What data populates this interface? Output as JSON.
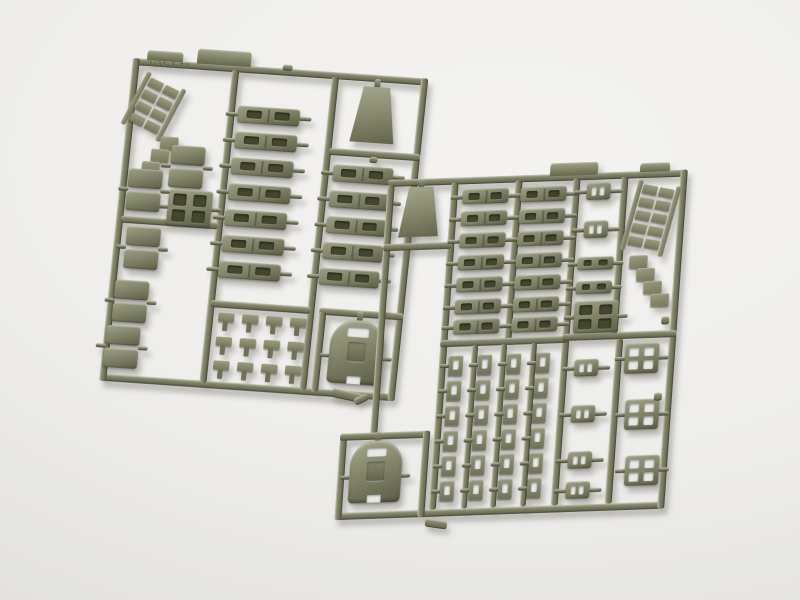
{
  "photo": {
    "embossed_text": "1/35 T-72",
    "colors": {
      "background": "#f4f3f1",
      "background_edge": "#d7d6d4",
      "plastic": "#7d7f64",
      "plastic_light": "#9da083",
      "plastic_dark": "#5b5d45",
      "slot": "#44462f",
      "hole": "#e9e8e4",
      "shadow": "rgba(108,106,94,0.42)"
    },
    "sprues": [
      {
        "id": "A",
        "name": "sprue-left",
        "origin": {
          "x": 133,
          "y": 58
        },
        "rotate": 4,
        "skew": -2,
        "width": 296,
        "height": 324,
        "rails": [
          [
            0,
            0,
            296,
            7
          ],
          [
            0,
            317,
            296,
            7
          ],
          [
            0,
            0,
            7,
            324
          ],
          [
            289,
            0,
            7,
            324
          ],
          [
            100,
            5,
            7,
            314
          ],
          [
            200,
            5,
            7,
            314
          ],
          [
            205,
            76,
            91,
            7
          ],
          [
            212,
            236,
            84,
            7
          ],
          [
            212,
            240,
            7,
            80
          ],
          [
            5,
            158,
            97,
            7
          ],
          [
            103,
            236,
            100,
            7
          ]
        ],
        "tabs": [
          [
            14,
            -9,
            36,
            10
          ],
          [
            64,
            -14,
            54,
            15
          ]
        ],
        "label_pos": {
          "x": 16,
          "y": 0.5,
          "w": 84
        },
        "parts": [
          {
            "t": "grid",
            "x": 16,
            "y": 12,
            "rows": 4,
            "rot": 22
          },
          {
            "t": "stair",
            "x": 36,
            "y": 76,
            "n": 3,
            "dx": -8,
            "dy": 13
          },
          {
            "t": "pair",
            "x": 48,
            "y": 84
          },
          {
            "t": "block4",
            "x": 50,
            "y": 128,
            "w": 44,
            "h": 36,
            "holes": false
          },
          {
            "t": "pair",
            "x": 8,
            "y": 110
          },
          {
            "t": "pair",
            "x": 12,
            "y": 168
          },
          {
            "t": "pair",
            "x": 6,
            "y": 222
          },
          {
            "t": "pair",
            "x": 2,
            "y": 268
          },
          {
            "t": "link",
            "x": 110,
            "y": 40,
            "w": 62,
            "h": 17
          },
          {
            "t": "link",
            "x": 110,
            "y": 66,
            "w": 62,
            "h": 17
          },
          {
            "t": "link",
            "x": 109,
            "y": 92,
            "w": 62,
            "h": 17
          },
          {
            "t": "link",
            "x": 109,
            "y": 118,
            "w": 62,
            "h": 17
          },
          {
            "t": "link",
            "x": 108,
            "y": 144,
            "w": 62,
            "h": 17
          },
          {
            "t": "link",
            "x": 108,
            "y": 170,
            "w": 62,
            "h": 17
          },
          {
            "t": "link",
            "x": 107,
            "y": 196,
            "w": 62,
            "h": 17
          },
          {
            "t": "trap",
            "x": 224,
            "y": 12,
            "w": 44,
            "h": 56
          },
          {
            "t": "link",
            "x": 211,
            "y": 92,
            "w": 60,
            "h": 17
          },
          {
            "t": "link",
            "x": 210,
            "y": 118,
            "w": 60,
            "h": 17
          },
          {
            "t": "link",
            "x": 210,
            "y": 144,
            "w": 60,
            "h": 17
          },
          {
            "t": "link",
            "x": 209,
            "y": 170,
            "w": 60,
            "h": 17
          },
          {
            "t": "link",
            "x": 208,
            "y": 196,
            "w": 60,
            "h": 17
          },
          {
            "t": "tgrid",
            "x": 112,
            "y": 248,
            "rows": 3,
            "cols": 4,
            "px": 24,
            "py": 24
          },
          {
            "t": "dome",
            "x": 226,
            "y": 246,
            "w": 54,
            "h": 64
          },
          {
            "t": "nub",
            "x": 150,
            "y": -4,
            "w": 10,
            "h": 6
          },
          {
            "t": "nub",
            "x": 246,
            "y": 82,
            "w": 8,
            "h": 6
          }
        ]
      },
      {
        "id": "B",
        "name": "sprue-right",
        "origin": {
          "x": 388,
          "y": 180
        },
        "rotate": -2,
        "skew": -6,
        "width": 300,
        "height": 338,
        "rails": [
          [
            0,
            0,
            300,
            7
          ],
          [
            -30,
            331,
            330,
            7
          ],
          [
            0,
            5,
            7,
            250
          ],
          [
            293,
            0,
            7,
            338
          ],
          [
            64,
            5,
            7,
            326
          ],
          [
            186,
            5,
            7,
            326
          ],
          [
            128,
            5,
            7,
            160
          ],
          [
            0,
            64,
            68,
            7
          ],
          [
            64,
            162,
            129,
            7
          ],
          [
            186,
            160,
            114,
            7
          ],
          [
            96,
            168,
            6,
            163
          ],
          [
            125,
            168,
            6,
            163
          ],
          [
            155,
            168,
            6,
            163
          ],
          [
            234,
            5,
            7,
            156
          ],
          [
            240,
            167,
            7,
            164
          ],
          [
            -30,
            252,
            7,
            86
          ],
          [
            -30,
            252,
            90,
            7
          ],
          [
            53,
            252,
            7,
            86
          ]
        ],
        "tabs": [
          [
            162,
            -11,
            48,
            13
          ],
          [
            252,
            -8,
            30,
            9
          ]
        ],
        "parts": [
          {
            "t": "trap",
            "x": 14,
            "y": 8,
            "w": 40,
            "h": 50
          },
          {
            "t": "link",
            "x": 76,
            "y": 12,
            "w": 46,
            "h": 15
          },
          {
            "t": "link",
            "x": 134,
            "y": 12,
            "w": 46,
            "h": 15
          },
          {
            "t": "link",
            "x": 76,
            "y": 34,
            "w": 46,
            "h": 15
          },
          {
            "t": "link",
            "x": 134,
            "y": 34,
            "w": 46,
            "h": 15
          },
          {
            "t": "link",
            "x": 76,
            "y": 56,
            "w": 46,
            "h": 15
          },
          {
            "t": "link",
            "x": 134,
            "y": 56,
            "w": 46,
            "h": 15
          },
          {
            "t": "link",
            "x": 76,
            "y": 78,
            "w": 46,
            "h": 15
          },
          {
            "t": "link",
            "x": 134,
            "y": 78,
            "w": 46,
            "h": 15
          },
          {
            "t": "link",
            "x": 76,
            "y": 100,
            "w": 46,
            "h": 15
          },
          {
            "t": "link",
            "x": 134,
            "y": 100,
            "w": 46,
            "h": 15
          },
          {
            "t": "link",
            "x": 76,
            "y": 122,
            "w": 46,
            "h": 15
          },
          {
            "t": "link",
            "x": 134,
            "y": 122,
            "w": 46,
            "h": 15
          },
          {
            "t": "link",
            "x": 76,
            "y": 142,
            "w": 46,
            "h": 15
          },
          {
            "t": "link",
            "x": 134,
            "y": 142,
            "w": 46,
            "h": 15
          },
          {
            "t": "padgrid",
            "x": 74,
            "y": 178,
            "rows": 6,
            "cols": 4,
            "px": 29,
            "py": 25
          },
          {
            "t": "pad2",
            "x": 200,
            "y": 10,
            "w": 24,
            "h": 17
          },
          {
            "t": "pad2",
            "x": 200,
            "y": 48,
            "w": 24,
            "h": 17
          },
          {
            "t": "bar2",
            "x": 196,
            "y": 84,
            "w": 36,
            "h": 13
          },
          {
            "t": "bar2",
            "x": 196,
            "y": 108,
            "w": 36,
            "h": 13
          },
          {
            "t": "block4",
            "x": 196,
            "y": 128,
            "w": 44,
            "h": 32,
            "holes": false
          },
          {
            "t": "grid",
            "x": 252,
            "y": 8,
            "rows": 5,
            "rot": 12
          },
          {
            "t": "stair",
            "x": 248,
            "y": 84,
            "n": 4,
            "dx": 8,
            "dy": 13
          },
          {
            "t": "pad2",
            "x": 200,
            "y": 186,
            "w": 24,
            "h": 17
          },
          {
            "t": "pad2",
            "x": 200,
            "y": 232,
            "w": 24,
            "h": 17
          },
          {
            "t": "pad2",
            "x": 200,
            "y": 278,
            "w": 24,
            "h": 17
          },
          {
            "t": "pad2",
            "x": 200,
            "y": 308,
            "w": 24,
            "h": 17
          },
          {
            "t": "block4",
            "x": 250,
            "y": 172,
            "w": 34,
            "h": 30,
            "holes": true
          },
          {
            "t": "block4",
            "x": 254,
            "y": 228,
            "w": 34,
            "h": 30,
            "holes": true
          },
          {
            "t": "block4",
            "x": 258,
            "y": 284,
            "w": 34,
            "h": 30,
            "holes": true
          },
          {
            "t": "dome",
            "x": -18,
            "y": 260,
            "w": 52,
            "h": 62
          },
          {
            "t": "nub",
            "x": 284,
            "y": 146,
            "w": 8,
            "h": 8
          },
          {
            "t": "nub",
            "x": 282,
            "y": 222,
            "w": 8,
            "h": 8
          }
        ]
      }
    ],
    "connectors": [
      {
        "x": 332,
        "y": 391,
        "w": 30,
        "h": 9,
        "rot": 12
      },
      {
        "x": 354,
        "y": 396,
        "w": 14,
        "h": 7,
        "rot": -25
      },
      {
        "x": 425,
        "y": 520,
        "w": 22,
        "h": 8,
        "rot": 8
      }
    ]
  }
}
